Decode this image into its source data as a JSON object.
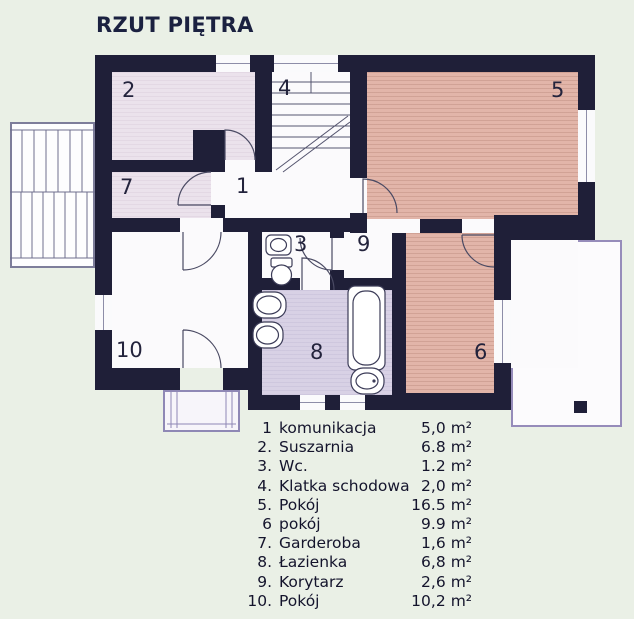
{
  "title": "RZUT PIĘTRA",
  "plan": {
    "labels": {
      "r1": "1",
      "r2": "2",
      "r3": "3",
      "r4": "4",
      "r5": "5",
      "r6": "6",
      "r7": "7",
      "r8": "8",
      "r9": "9",
      "r10": "10"
    }
  },
  "legend": {
    "items": [
      {
        "num": "1",
        "name": "komunikacja",
        "area": "5,0",
        "unit": "m²"
      },
      {
        "num": "2.",
        "name": "Suszarnia",
        "area": "6.8",
        "unit": "m²"
      },
      {
        "num": "3.",
        "name": "Wc.",
        "area": "1.2",
        "unit": "m²"
      },
      {
        "num": "4.",
        "name": "Klatka schodowa",
        "area": "2,0",
        "unit": "m²"
      },
      {
        "num": "5.",
        "name": "Pokój",
        "area": "16.5",
        "unit": "m²"
      },
      {
        "num": "6",
        "name": "pokój",
        "area": "9.9",
        "unit": "m²"
      },
      {
        "num": "7.",
        "name": "Garderoba",
        "area": "1,6",
        "unit": "m²"
      },
      {
        "num": "8.",
        "name": "Łazienka",
        "area": "6,8",
        "unit": "m²"
      },
      {
        "num": "9.",
        "name": "Korytarz",
        "area": "2,6",
        "unit": "m²"
      },
      {
        "num": "10.",
        "name": "Pokój",
        "area": "10,2",
        "unit": "m²"
      }
    ]
  },
  "colors": {
    "wall": "#1f1f38",
    "room_warm": "#e2b5a9",
    "room_light_pink": "#ebe2ec",
    "room_lavender": "#d8d1e5",
    "background": "#eaf0e6",
    "terrace_outline": "#968cba"
  }
}
